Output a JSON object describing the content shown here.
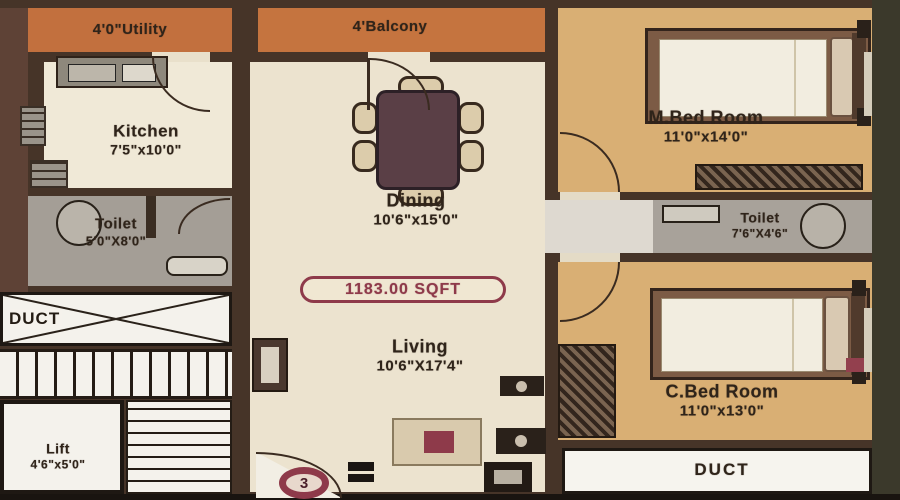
{
  "colors": {
    "wall": "#463428",
    "wall_red": "#5e4236",
    "floor": "#ece3cf",
    "bedroom": "#d9af74",
    "balcony": "#c2703e",
    "toilet": "#a49e96",
    "passage": "#ded9d0",
    "duct_white": "#f4f2ec",
    "maroon": "#8e3a4a",
    "ink": "#2f241a",
    "edge_olive": "#3b392b",
    "edge_dark": "#191410"
  },
  "plan": {
    "area_badge": "1183.00 SQFT",
    "unit_circle": "3",
    "rooms": {
      "utility": {
        "label": "4'0\"Utility"
      },
      "balcony": {
        "label": "4'Balcony"
      },
      "kitchen": {
        "label": "Kitchen",
        "dims": "7'5\"x10'0\""
      },
      "dining": {
        "label": "Dining",
        "dims": "10'6\"x15'0\""
      },
      "living": {
        "label": "Living",
        "dims": "10'6\"X17'4\""
      },
      "master_bedroom": {
        "label": "M.Bed Room",
        "dims": "11'0\"x14'0\""
      },
      "child_bedroom": {
        "label": "C.Bed Room",
        "dims": "11'0\"x13'0\""
      },
      "toilet_left": {
        "label": "Toilet",
        "dims": "5'0\"X8'0\""
      },
      "toilet_right": {
        "label": "Toilet",
        "dims": "7'6\"X4'6\""
      },
      "lift": {
        "label": "Lift",
        "dims": "4'6\"x5'0\""
      },
      "duct_left": {
        "label": "DUCT"
      },
      "duct_bottom": {
        "label": "DUCT"
      }
    }
  }
}
